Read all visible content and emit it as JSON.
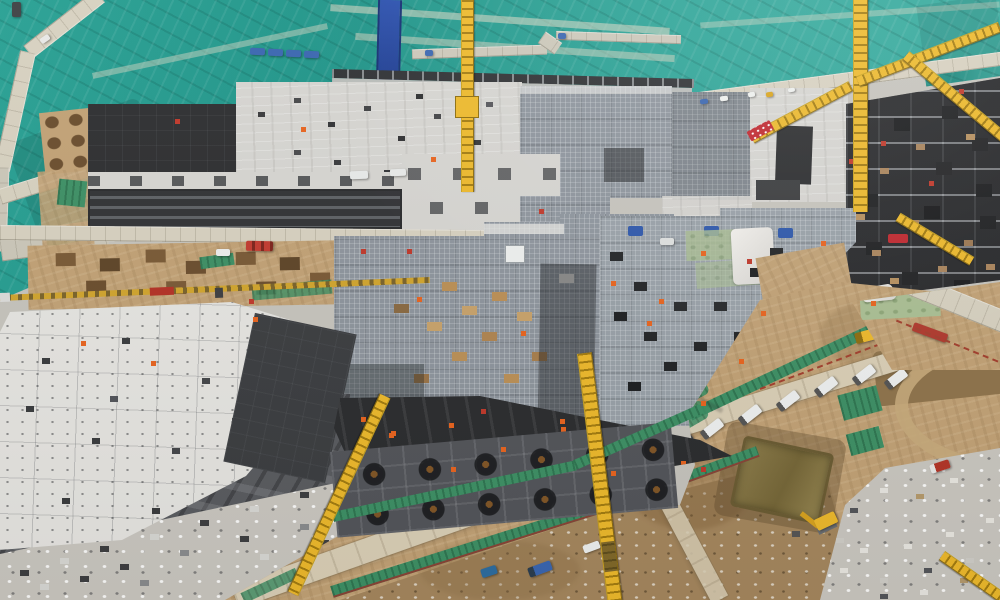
{
  "image": {
    "kind": "Aerial drone photograph of a large building construction site with tower cranes, dust-control netting, concrete foundation decks and earthworks",
    "width_px": 1000,
    "height_px": 600,
    "visible_text": ""
  },
  "palette": {
    "netting_teal": "#28a093",
    "net_green": "#3e9065",
    "road_light": "#d7d1c0",
    "paver_gray": "#cbc7b9",
    "dirt_tan": "#c2a276",
    "dirt_rough": "#a5875e",
    "slab_white": "#e6e5e1",
    "slab_light": "#d6d5d1",
    "slab_dark": "#2e2f31",
    "formwork_gray": "#3f4043",
    "rebar_gray": "#8e959d",
    "gravel_gray": "#cac7c0",
    "crane_yellow": "#edb92c",
    "crane_dark": "#a37c10",
    "tarp_blue": "#2d57ab",
    "truck_blue": "#3a66b0",
    "safety_orange": "#e8641f",
    "safety_red": "#c0392b",
    "timber_tan": "#bb9057",
    "pond_olive": "#867645",
    "wall_dark": "#2f3134"
  },
  "scene": {
    "regions": [
      {
        "name": "dust-control-netting",
        "desc": "teal mesh covering graded slopes across the top"
      },
      {
        "name": "perimeter-haul-roads",
        "desc": "light concrete roads crossing the netting and site"
      },
      {
        "name": "foundation-decks",
        "desc": "rebar mats, concrete slabs and dark formwork zones in the center"
      },
      {
        "name": "white-raft-slab",
        "desc": "bright slab with module grid and anchor-bolt clusters, lower left"
      },
      {
        "name": "pile-cap-slab",
        "desc": "dark slab with rows of circular pile caps, bottom center"
      },
      {
        "name": "earthworks-corridor",
        "desc": "tan excavation corridor with haul roads and green netting strips, bottom right"
      },
      {
        "name": "sediment-pond",
        "desc": "olive retention pond within the earthworks"
      },
      {
        "name": "materials-yard",
        "desc": "gravel laydown area with stacked materials, bottom right corner"
      }
    ],
    "equipment": {
      "tower_cranes_visible": 8,
      "excavators": 1,
      "dump_trucks": 2,
      "parked_white_vans": 6,
      "blue_site_trucks": 5
    }
  }
}
